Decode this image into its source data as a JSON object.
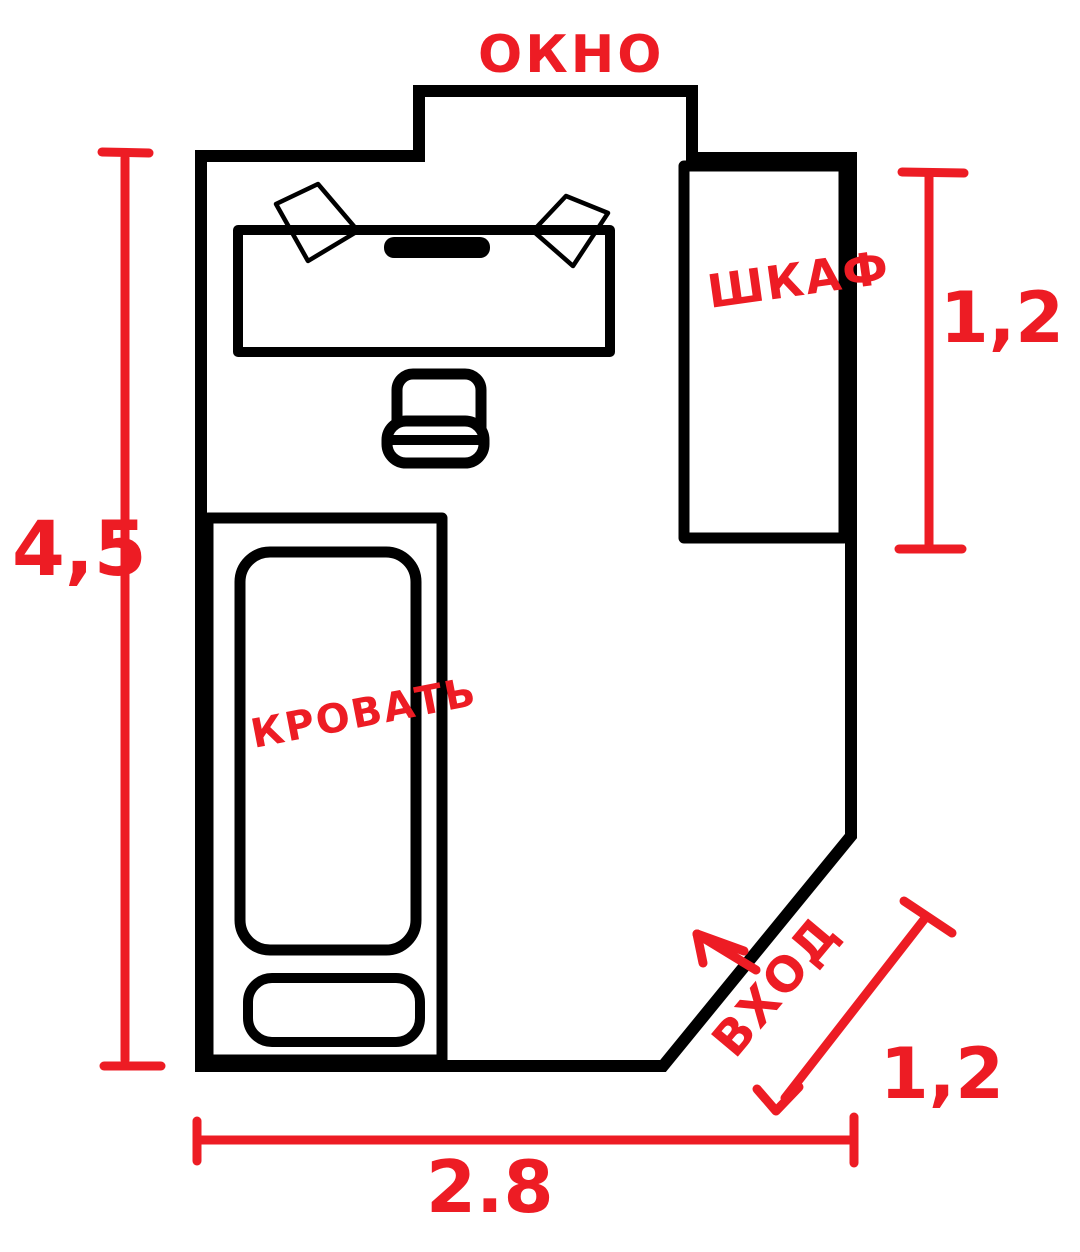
{
  "plan": {
    "colors": {
      "ink": "#000000",
      "annotation": "#ed1c24",
      "background": "#ffffff"
    },
    "room": {
      "labels": {
        "window": "ОКНО",
        "wardrobe": "ШКАФ",
        "bed": "КРОВАТЬ",
        "entrance": "ВХОД"
      }
    },
    "dimensions": {
      "left_height": "4,5",
      "wardrobe_length": "1,2",
      "bottom_width": "2.8",
      "entrance_width": "1,2"
    }
  }
}
